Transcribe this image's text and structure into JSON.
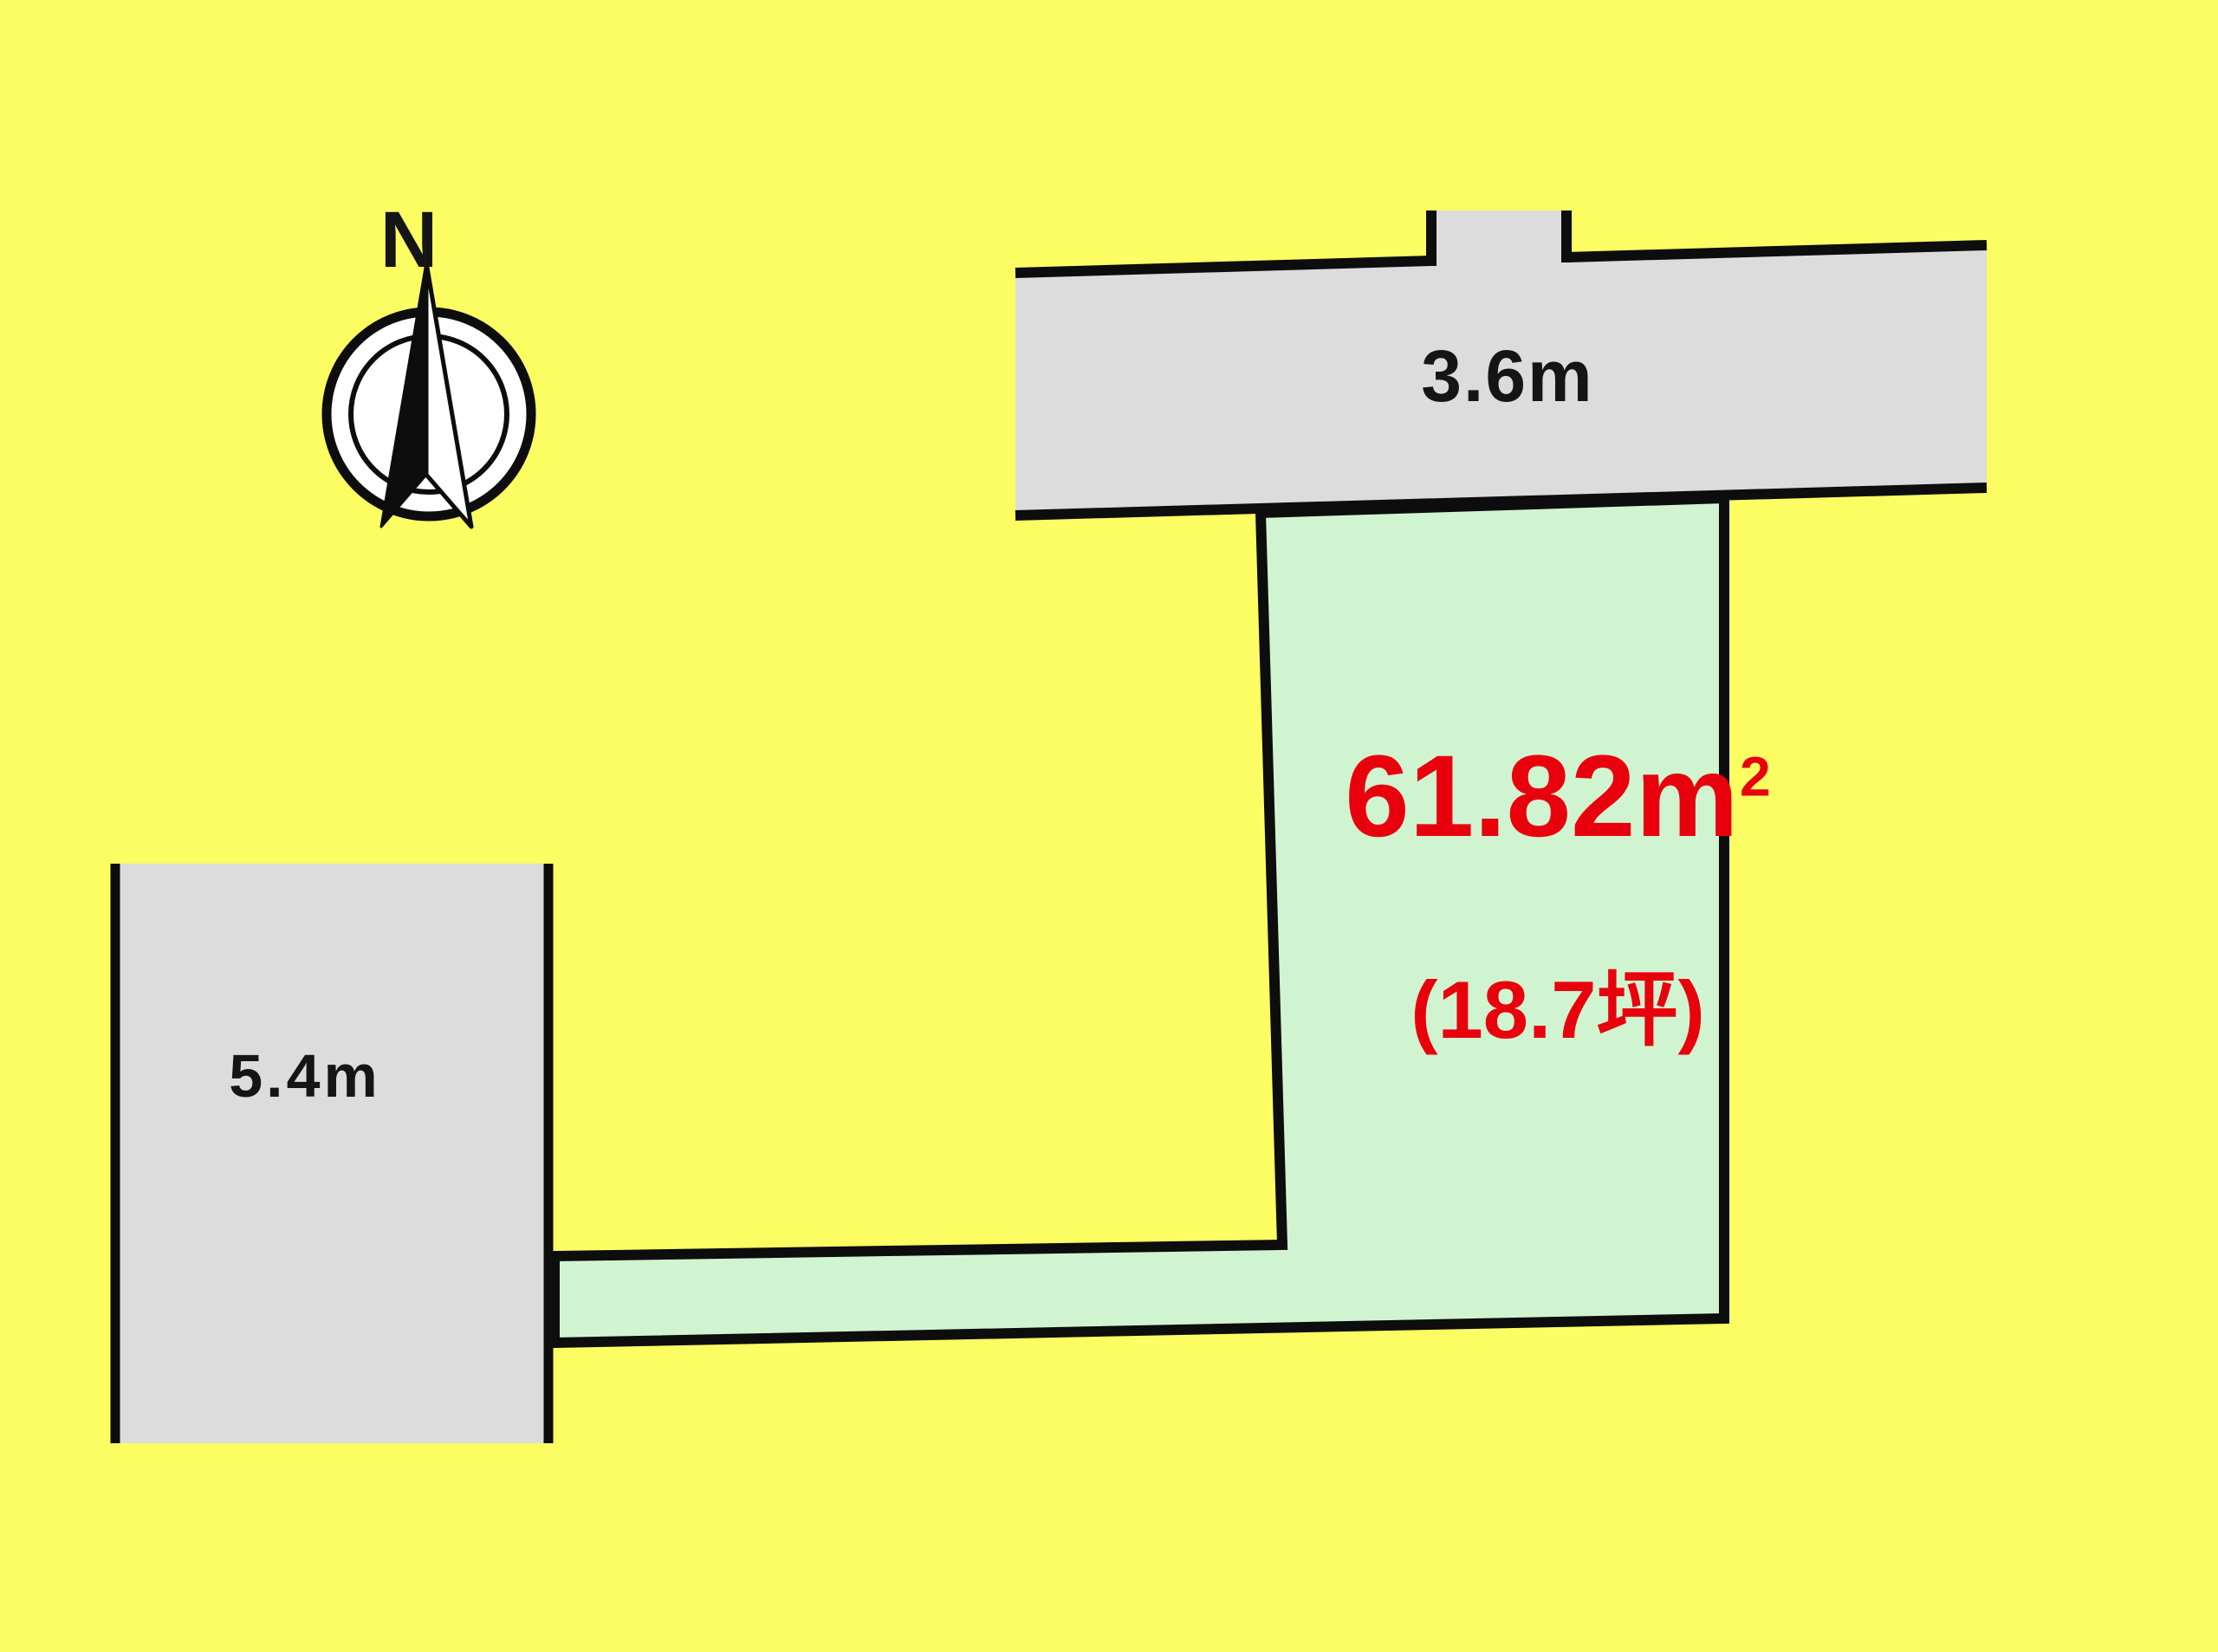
{
  "page": {
    "type": "land-plot-diagram"
  },
  "compass": {
    "north_label": "N"
  },
  "roads": {
    "top": {
      "width_label": "3.6m"
    },
    "left": {
      "width_label": "5.4m"
    }
  },
  "plot": {
    "area_value": "61.82m",
    "area_superscript": "2",
    "area_tsubo": "(18.7坪)"
  },
  "colors": {
    "background": "#FBFD62",
    "road_fill": "#DCDCDC",
    "plot_fill": "#D1F4D0",
    "outline": "#0D0D0D",
    "accent_red": "#E8000D",
    "label_black": "#151515"
  }
}
